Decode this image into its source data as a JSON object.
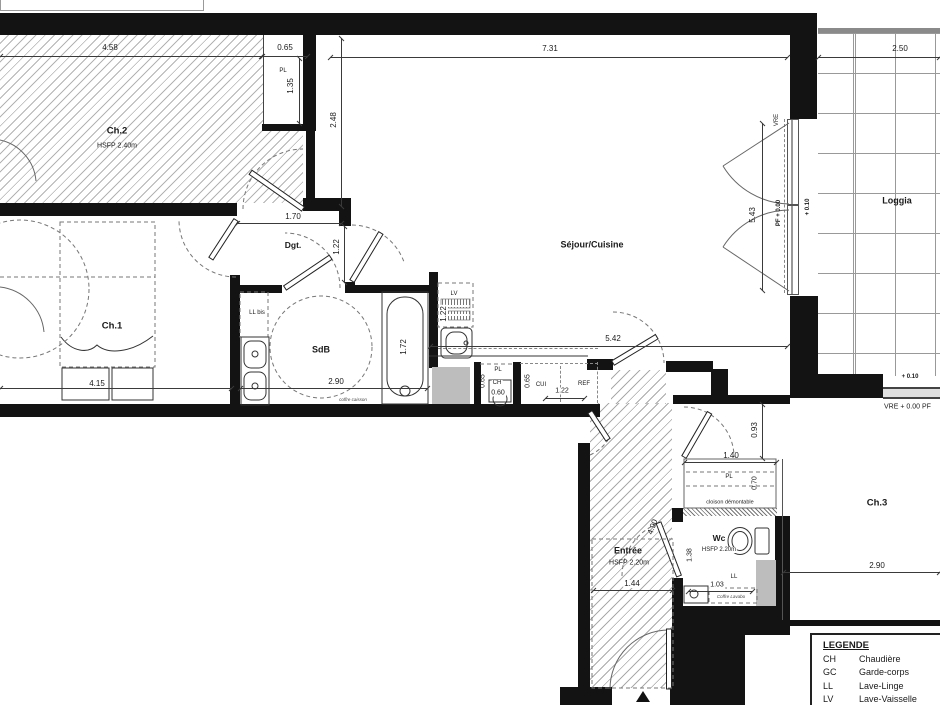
{
  "rooms": {
    "ch2": {
      "name": "Ch.2",
      "hsfp": "HSFP 2.40m"
    },
    "ch1": {
      "name": "Ch.1"
    },
    "sdb": {
      "name": "SdB"
    },
    "dgt": {
      "name": "Dgt."
    },
    "sejour": {
      "name": "Séjour/Cuisine"
    },
    "loggia": {
      "name": "Loggia"
    },
    "entree": {
      "name": "Entrée",
      "hsfp": "HSFP 2.20m"
    },
    "wc": {
      "name": "Wc",
      "hsfp": "HSFP 2.20m"
    },
    "ch3": {
      "name": "Ch.3"
    }
  },
  "dimensions": {
    "ch2_width": "4.58",
    "ch2_pl_width": "0.65",
    "ch2_pl_depth": "1.35",
    "sejour_width": "7.31",
    "sejour_left_depth": "2.48",
    "sejour_length": "5.42",
    "loggia_width": "2.50",
    "loggia_depth": "5.43",
    "dgt_width": "1.70",
    "dgt_depth": "1.22",
    "ch1_width": "4.15",
    "sdb_width": "2.90",
    "bath_length": "1.72",
    "lv_depth": "1.22",
    "pl_k_depth": "0.65",
    "ch_width": "0.60",
    "cui_depth": "0.65",
    "cui_width": "1.22",
    "ch3_entry": "0.93",
    "ch3_pl_width": "1.40",
    "ch3_pl_depth": "0.70",
    "wc_door": "4.90",
    "wc_depth": "1.38",
    "wc_width": "1.03",
    "entree_width": "1.44",
    "ch3_width": "2.90"
  },
  "levels": {
    "vre": "VRE",
    "pf_level": "PF + 0.00",
    "loggia_level": "+ 0.10",
    "loggia_level_b": "+ 0.10",
    "ch3_window": "VRE + 0.00    PF"
  },
  "annotations": {
    "pl_ch2": "PL",
    "ll_bis": "LL bis",
    "lv": "LV",
    "pl_kitchen": "PL",
    "ch": "CH",
    "cui": "CUI",
    "ref": "REF",
    "pl_ch3": "PL",
    "cloison": "cloison démontable",
    "ll": "LL",
    "coffre_sdb": "coffre caisson",
    "coffre_ll": "Coffre Lavabo"
  },
  "legend": {
    "title": "LEGENDE",
    "entries": [
      {
        "abbr": "CH",
        "label": "Chaudière"
      },
      {
        "abbr": "GC",
        "label": "Garde-corps"
      },
      {
        "abbr": "LL",
        "label": "Lave-Linge"
      },
      {
        "abbr": "LV",
        "label": "Lave-Vaisselle"
      },
      {
        "abbr": "CUI",
        "label": "Cuisson"
      }
    ]
  },
  "colors": {
    "wall": "#131313",
    "hatch": "#b3b3b3",
    "shaft": "#bdbdbd",
    "dim": "#3a3a3a"
  }
}
